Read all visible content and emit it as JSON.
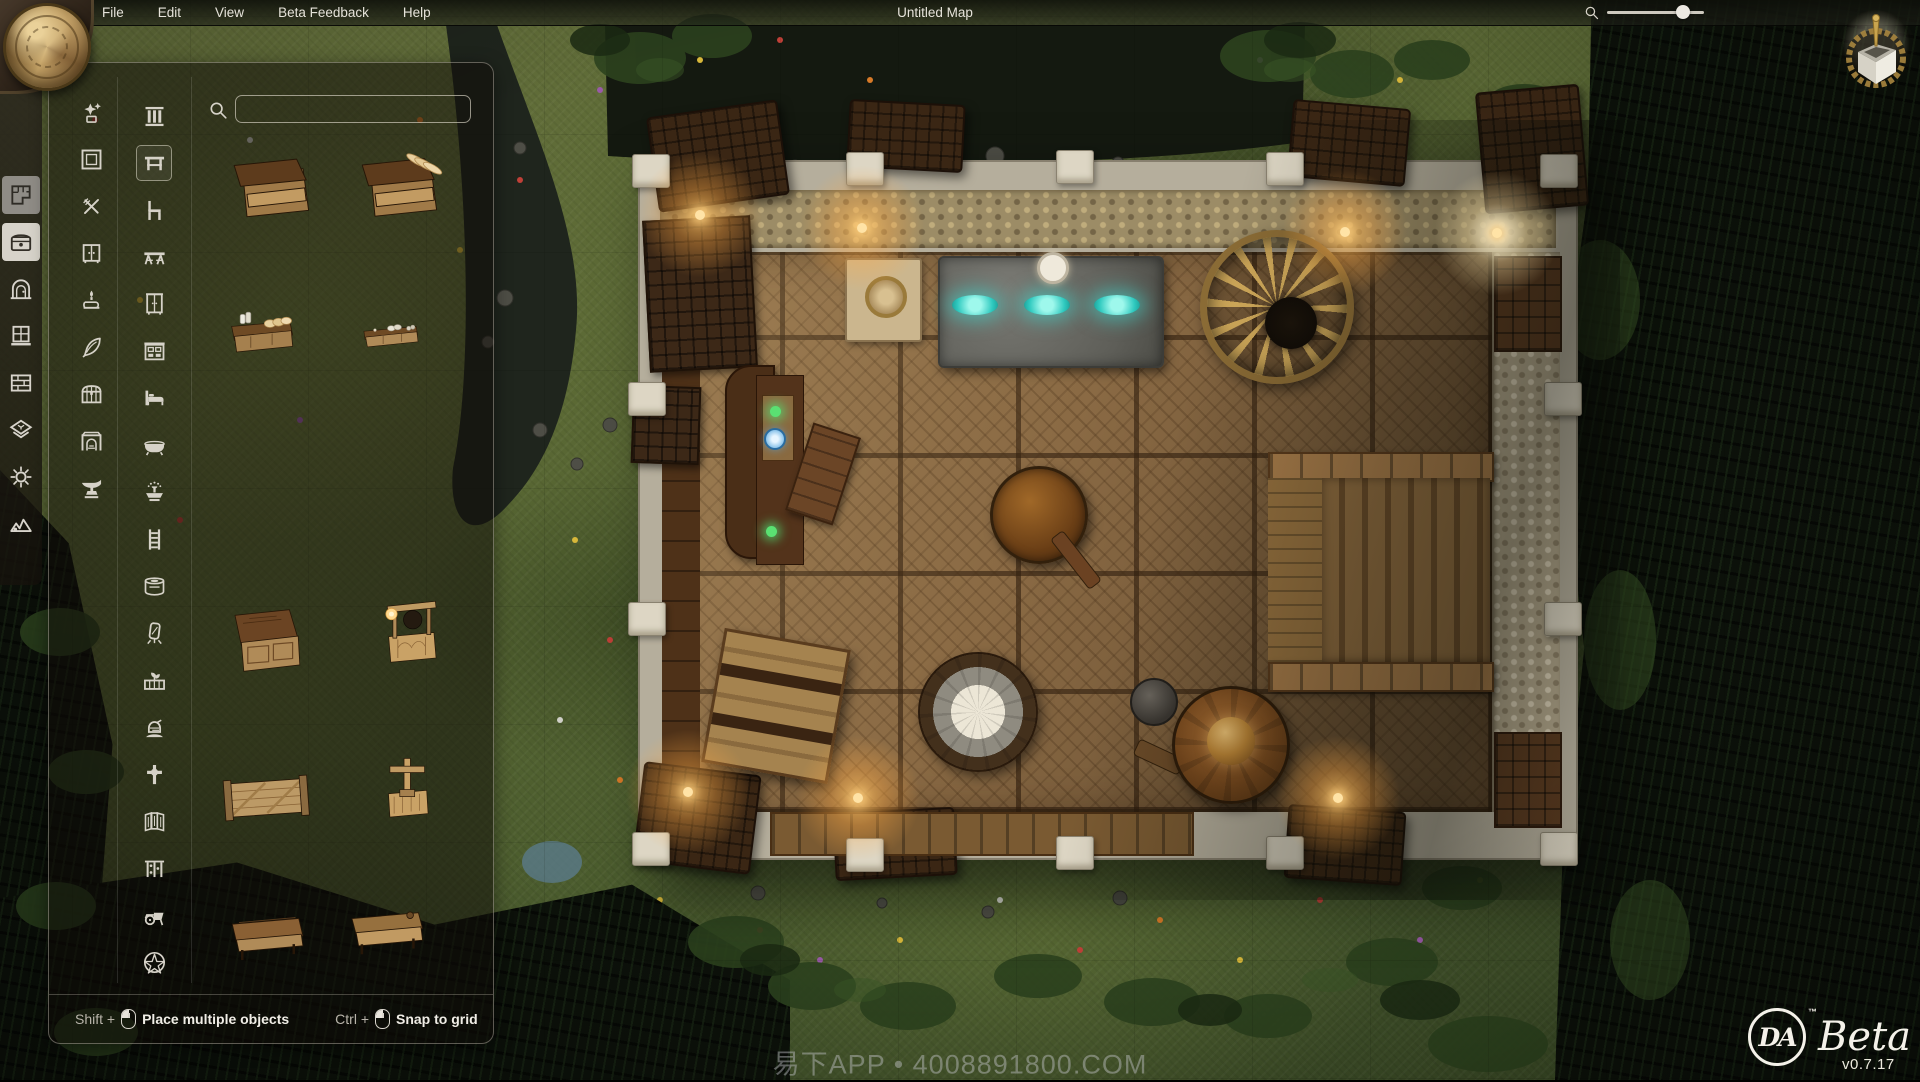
{
  "app": {
    "window_title": "Untitled Map",
    "brand_abbrev": "DA",
    "trademark": "™",
    "beta_label": "Beta",
    "version": "v0.7.17",
    "watermark": "易下APP • 4008891800.COM"
  },
  "menu": {
    "items": [
      {
        "label": "File"
      },
      {
        "label": "Edit"
      },
      {
        "label": "View"
      },
      {
        "label": "Beta Feedback"
      },
      {
        "label": "Help"
      }
    ]
  },
  "zoom_control": {
    "icon": "search",
    "value_pct": 78
  },
  "view_toggle": {
    "icon": "cube-3d"
  },
  "toolbar": {
    "items": [
      {
        "icon": "floorplan",
        "name": "rooms",
        "active": false,
        "dim_highlight": true
      },
      {
        "icon": "chest",
        "name": "objects",
        "active": true,
        "dim_highlight": false
      },
      {
        "icon": "door",
        "name": "doors",
        "active": false,
        "dim_highlight": false
      },
      {
        "icon": "window",
        "name": "windows",
        "active": false,
        "dim_highlight": false
      },
      {
        "icon": "wall",
        "name": "walls",
        "active": false,
        "dim_highlight": false
      },
      {
        "icon": "floor",
        "name": "floors",
        "active": false,
        "dim_highlight": false
      },
      {
        "icon": "light",
        "name": "lights",
        "active": false,
        "dim_highlight": false
      },
      {
        "icon": "terrain",
        "name": "terrain",
        "active": false,
        "dim_highlight": false
      }
    ]
  },
  "object_panel": {
    "search": {
      "placeholder": "",
      "value": "",
      "icon": "search"
    },
    "categories_col1": [
      {
        "icon": "new"
      },
      {
        "icon": "frame"
      },
      {
        "icon": "utensils"
      },
      {
        "icon": "cabinet"
      },
      {
        "icon": "candle"
      },
      {
        "icon": "quill"
      },
      {
        "icon": "chest"
      },
      {
        "icon": "fireplace"
      },
      {
        "icon": "anvil"
      }
    ],
    "categories_col2": [
      {
        "icon": "pillars"
      },
      {
        "icon": "table",
        "selected": true
      },
      {
        "icon": "chair"
      },
      {
        "icon": "long-table"
      },
      {
        "icon": "armoire"
      },
      {
        "icon": "hutch"
      },
      {
        "icon": "bed"
      },
      {
        "icon": "bathtub"
      },
      {
        "icon": "fountain"
      },
      {
        "icon": "ladder"
      },
      {
        "icon": "stove"
      },
      {
        "icon": "mirror"
      },
      {
        "icon": "planter"
      },
      {
        "icon": "armor"
      },
      {
        "icon": "grave-cross"
      },
      {
        "icon": "folding-screen"
      },
      {
        "icon": "trellis"
      },
      {
        "icon": "cart"
      },
      {
        "icon": "pentagram"
      }
    ],
    "objects": [
      "stall-table",
      "stall-table-bread",
      "counter-dairy",
      "counter-pastry",
      "wooden-cabinet",
      "lantern-stand",
      "wooden-gate",
      "cross-post",
      "workbench",
      "workbench-shelf"
    ],
    "hints": [
      {
        "key": "Shift +",
        "action": "Place multiple objects"
      },
      {
        "key": "Ctrl +",
        "action": "Snap to grid"
      }
    ]
  },
  "colors": {
    "lantern_glow": "#ffb75e",
    "flame_cyan": "#3fe0d4",
    "panel_border": "#d8d2c6",
    "wood_floor": "#8a6a44",
    "stone_wall": "#b5ae9c",
    "grass": "#5c6b35"
  }
}
